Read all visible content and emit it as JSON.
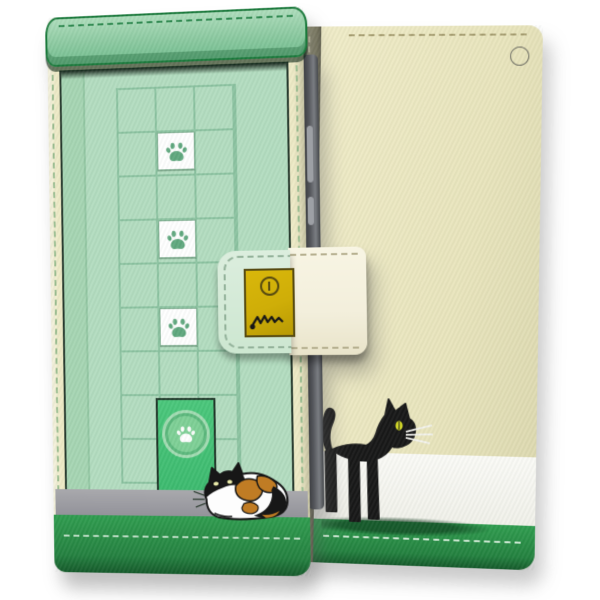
{
  "scene": {
    "type": "product-photo",
    "subject": "Cat-themed flip wallet smartphone case shown from front (closed) and back",
    "background_color": "#ffffff"
  },
  "palette": {
    "cream": "#eeeac6",
    "back_cream": "#e9e5bd",
    "front_green": "#b3ddc0",
    "shade_green": "#a6d5b3",
    "grid_line": "#8cc3a1",
    "band_green": "#8ccaa1",
    "band_border": "#1b7a3c",
    "stitch_green": "#2f8a50",
    "door_green": "#3cbb6f",
    "door_ring": "#a4ddb4",
    "paw_green": "#5fa87e",
    "tile_white": "#ffffff",
    "gray_strip": "#93939a",
    "bottom_green": "#2f9d4f",
    "bottom_green_dark": "#14592a",
    "white_band": "#fbfbf7",
    "spine_olive": "#8e8c72",
    "phone_edge": "#55575c",
    "gold": "#cfae08",
    "gold_border": "#564a11",
    "strap_cream": "#f3efdc",
    "strap_flap": "#cde7d1",
    "stitch_cream": "#b6b090",
    "cat_black": "#171717",
    "calico_white": "#fdfdfd",
    "calico_orange": "#c07c24",
    "calico_eye": "#e8e9a8",
    "eye_yellow": "#d9df25"
  },
  "front_view": {
    "paw_tile_count": 3,
    "elements": [
      "cover-top-band",
      "grid-wall",
      "paw-tiles",
      "pet-door",
      "door-paw-medallion",
      "calico-cat",
      "baseboard-strip",
      "bottom-green-band",
      "clasp-flap",
      "clasp-snap-plate",
      "clasp-strap-band",
      "phone-side-edge"
    ]
  },
  "back_view": {
    "elements": [
      "case-spine",
      "strap-eyelet",
      "cream-wall",
      "white-band",
      "green-band",
      "black-cat",
      "cat-shadow"
    ]
  }
}
